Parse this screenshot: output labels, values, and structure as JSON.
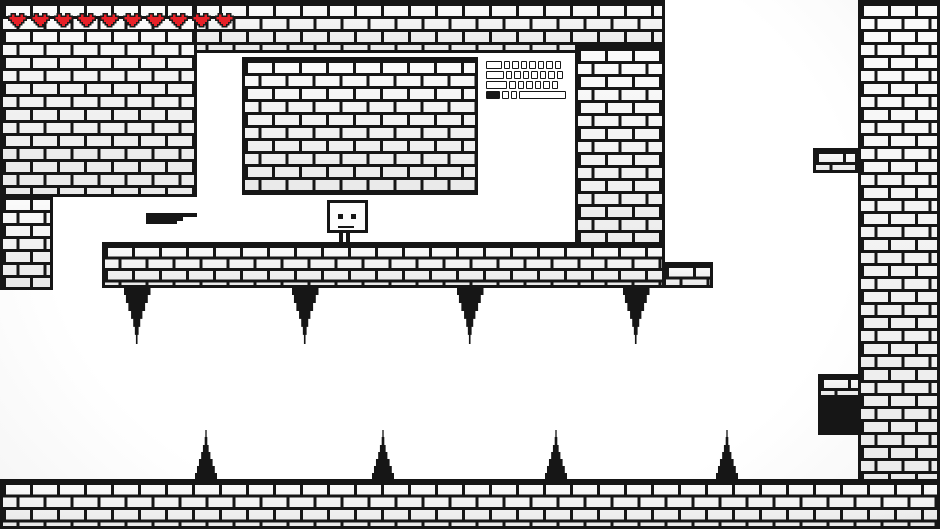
{
  "colors": {
    "ink": "#161616",
    "brick_fill": "#f2f2f2",
    "heart_red": "#e62128",
    "heart_outline": "#1a1a1a",
    "background_vignette": "#dedede"
  },
  "hud": {
    "hearts": {
      "count": 10,
      "width": 19,
      "height": 17
    }
  },
  "world": {
    "structures": [
      {
        "name": "ceiling-strip",
        "x": 0,
        "y": 0,
        "w": 665,
        "h": 53,
        "type": "bricks"
      },
      {
        "name": "upper-left-block",
        "x": 0,
        "y": 0,
        "w": 197,
        "h": 197,
        "type": "bricks"
      },
      {
        "name": "left-column",
        "x": 0,
        "y": 194,
        "w": 53,
        "h": 96,
        "type": "bricks"
      },
      {
        "name": "mid-hanging-block",
        "x": 242,
        "y": 57,
        "w": 236,
        "h": 138,
        "type": "bricks"
      },
      {
        "name": "center-column",
        "x": 575,
        "y": 45,
        "w": 90,
        "h": 243,
        "type": "bricks"
      },
      {
        "name": "main-platform",
        "x": 102,
        "y": 242,
        "w": 563,
        "h": 46,
        "type": "bricks",
        "brickH": 11.5
      },
      {
        "name": "platform-right-step",
        "x": 663,
        "y": 262,
        "w": 50,
        "h": 26,
        "type": "bricks",
        "brickH": 11.5
      },
      {
        "name": "right-wall",
        "x": 858,
        "y": 0,
        "w": 82,
        "h": 529,
        "type": "bricks"
      },
      {
        "name": "right-upper-ledge",
        "x": 813,
        "y": 148,
        "w": 45,
        "h": 25,
        "type": "bricks",
        "brickH": 11
      },
      {
        "name": "right-lower-ledge",
        "x": 818,
        "y": 374,
        "w": 43,
        "h": 24,
        "type": "bricks",
        "brickH": 11
      },
      {
        "name": "black-block",
        "x": 818,
        "y": 398,
        "w": 43,
        "h": 37,
        "type": "solid"
      },
      {
        "name": "ground-floor",
        "x": 0,
        "y": 479,
        "w": 940,
        "h": 50,
        "type": "bricks",
        "brickH": 12.5
      }
    ],
    "spikes": {
      "hanging": {
        "y": 287,
        "w": 27,
        "h": 57,
        "items": [
          {
            "cx": 137
          },
          {
            "cx": 305
          },
          {
            "cx": 470
          },
          {
            "cx": 636
          }
        ]
      },
      "ground": {
        "baseY": 480,
        "w": 22,
        "h": 50,
        "items": [
          {
            "cx": 206
          },
          {
            "cx": 383
          },
          {
            "cx": 556
          },
          {
            "cx": 727
          }
        ]
      }
    },
    "entities": {
      "player": {
        "x": 327,
        "y": 200
      },
      "gun_pickup": {
        "x": 146,
        "y": 213
      },
      "keyboard_pickup": {
        "x": 486,
        "y": 61,
        "rows": [
          {
            "keys": [
              {
                "w": 15.5
              },
              {
                "w": 6.5
              },
              {
                "w": 6.5
              },
              {
                "w": 6.5
              },
              {
                "w": 6.5
              },
              {
                "w": 6.5
              },
              {
                "w": 6.5
              },
              {
                "w": 6.5
              }
            ]
          },
          {
            "keys": [
              {
                "w": 17.5
              },
              {
                "w": 6.5
              },
              {
                "w": 6.5
              },
              {
                "w": 6.5
              },
              {
                "w": 6.5
              },
              {
                "w": 6.5
              },
              {
                "w": 6.5
              },
              {
                "w": 6.5
              }
            ]
          },
          {
            "keys": [
              {
                "w": 21
              },
              {
                "w": 6.5
              },
              {
                "w": 6.5
              },
              {
                "w": 6.5
              },
              {
                "w": 6.5
              },
              {
                "w": 6.5
              },
              {
                "w": 6.5
              }
            ]
          },
          {
            "keys": [
              {
                "w": 14,
                "filled": true
              },
              {
                "w": 6.5
              },
              {
                "w": 6.5
              },
              {
                "w": 47
              }
            ]
          }
        ]
      }
    }
  }
}
